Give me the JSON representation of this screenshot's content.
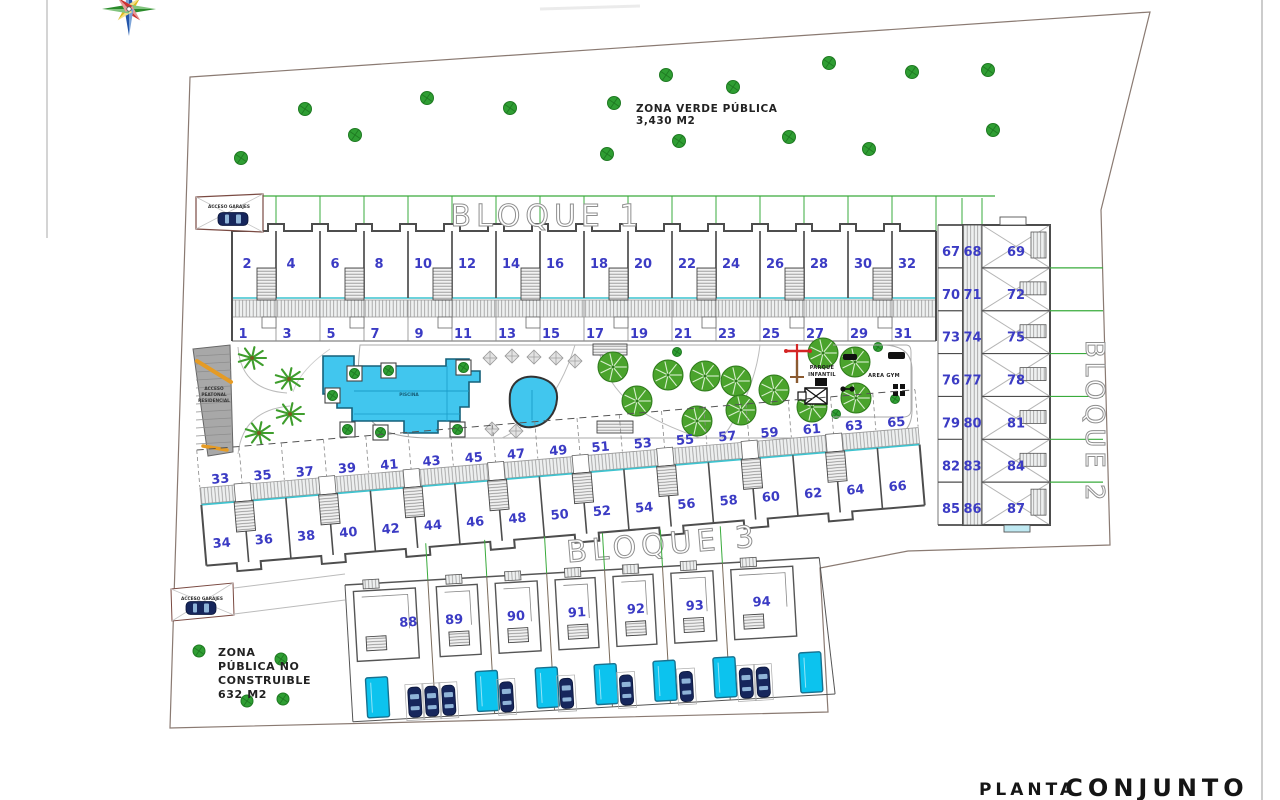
{
  "title": {
    "small": "PLANTA",
    "large": "CONJUNTO"
  },
  "areas": {
    "zona_verde_line1": "ZONA VERDE PÚBLICA",
    "zona_verde_line2": "3,430 M2",
    "zona_publica_lines": [
      "ZONA",
      "PÚBLICA NO",
      "CONSTRUIBLE",
      "632 M2"
    ]
  },
  "blocks": {
    "bloque1": {
      "label": "BLOQUE 1",
      "top_row": [
        2,
        4,
        6,
        8,
        10,
        12,
        14,
        16,
        18,
        20,
        22,
        24,
        26,
        28,
        30,
        32
      ],
      "bottom_row": [
        1,
        3,
        5,
        7,
        9,
        11,
        13,
        15,
        17,
        19,
        21,
        23,
        25,
        27,
        29,
        31
      ]
    },
    "bloque2": {
      "label": "BLOQUE 2",
      "rows": [
        [
          67,
          68,
          69
        ],
        [
          70,
          71,
          72
        ],
        [
          73,
          74,
          75
        ],
        [
          76,
          77,
          78
        ],
        [
          79,
          80,
          81
        ],
        [
          82,
          83,
          84
        ],
        [
          85,
          86,
          87
        ]
      ]
    },
    "bloque3": {
      "label": "BLOQUE 3",
      "top_row": [
        33,
        35,
        37,
        39,
        41,
        43,
        45,
        47,
        49,
        51,
        53,
        55,
        57,
        59,
        61,
        63,
        65
      ],
      "bottom_row": [
        34,
        36,
        38,
        40,
        42,
        44,
        46,
        48,
        50,
        52,
        54,
        56,
        58,
        60,
        62,
        64,
        66
      ]
    },
    "villas": {
      "numbers": [
        88,
        89,
        90,
        91,
        92,
        93,
        94
      ]
    }
  },
  "labels": {
    "acceso_garajes_top": "ACCESO GARAJES",
    "acceso_garajes_bottom": "ACCESO GARAJES",
    "acceso_peatonal_lines": [
      "ACCESO",
      "PEATONAL",
      "RESIDENCIAL"
    ],
    "piscina": "PISCINA",
    "parque_infantil_lines": [
      "PARQUE",
      "INFANTIL"
    ],
    "area_gym": "AREA GYM"
  },
  "colors": {
    "unit_number": "#3b3bc4",
    "green_line": "#3aab3c",
    "tree_fill": "#4aa32c",
    "tree_dark": "#2e7a1b",
    "pool_fill": "#41c6ee",
    "pool_line": "#1a9cc8",
    "private_pool": "#0cc3ee",
    "teal_edge": "#3cc3cf",
    "car_body": "#16265c",
    "site_boundary": "#8a7a72",
    "building_line": "#4d4d4d",
    "playground_red": "#d42525",
    "handrail_orange": "#e59b25"
  }
}
